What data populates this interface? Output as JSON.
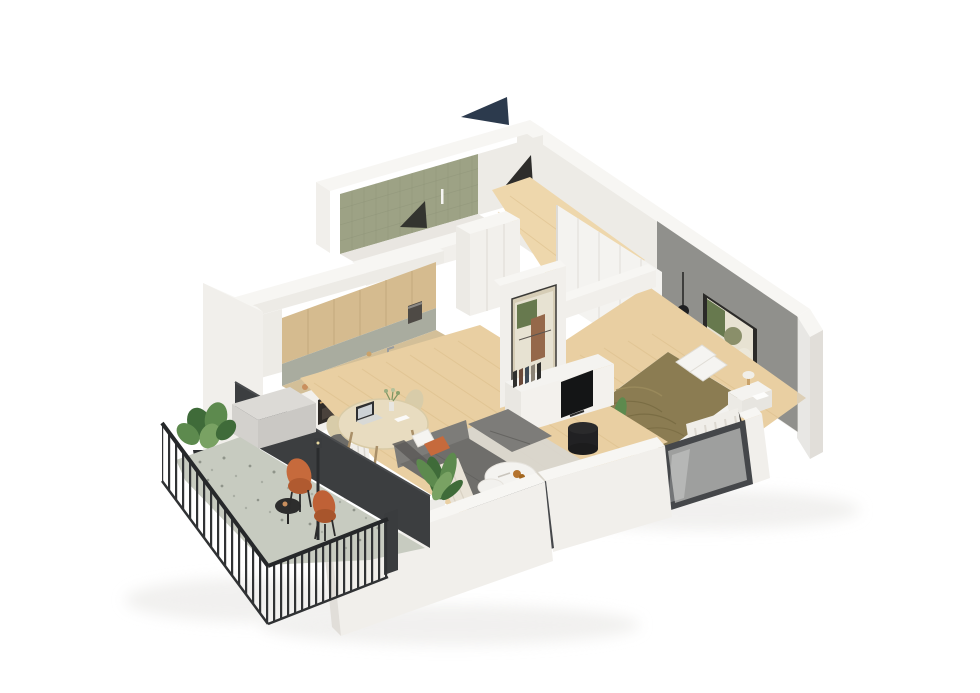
{
  "meta": {
    "description": "3D isometric cutaway rendering of a one-bedroom apartment floor plan on a white background, with north arrow, balcony, kitchen, living-dining room, bedroom and bathroom"
  },
  "compass": {
    "name": "north-arrow"
  },
  "palette": {
    "bg": "#ffffff",
    "navy": "#2c3a4d",
    "wallTop": "#f7f6f3",
    "wallLight": "#f1efeb",
    "wallMid": "#e1ded9",
    "wallShade": "#d2cfca",
    "wallInner": "#edebe6",
    "accentGray": "#90908c",
    "floorWood": "#e9cfa2",
    "floorWoodLight": "#eed7ac",
    "floorWoodLine": "#d8b983",
    "floorBath": "#e9e6e1",
    "tileOlive": "#9da285",
    "terrazzo": "#c7cbc0",
    "speckleA": "#8f948a",
    "speckleB": "#a9aea3",
    "darkWall": "#3c3e40",
    "railing": "#303234",
    "oak": "#d5bb8f",
    "backsplash": "#a9ac9f",
    "counter": "#d3bf98",
    "baseCab": "#f2f0ec",
    "applianceDark": "#2f3032",
    "bronze": "#c9a26a",
    "sofa": "#6f6e6b",
    "sofaLight": "#7d7c79",
    "sofaDark": "#5c5b58",
    "orange": "#c66a3c",
    "softWhite": "#f4f3f0",
    "throw": "#e9e3d7",
    "rug": "#d8d6d0",
    "duvet": "#8b7c52",
    "duvetShade": "#74673f",
    "pillow": "#f5f4f1",
    "plantDark": "#3f6b39",
    "plant": "#5d8a4e",
    "plantLight": "#79a263",
    "black": "#1f2022",
    "frameDark": "#3a3836",
    "artGreen": "#67794e",
    "artBrown": "#95684a",
    "artCream": "#e7e2d2",
    "glass": "#e8e8e4",
    "windowFrame": "#45474a",
    "woodLeg": "#a98f68",
    "chairBeige": "#d8cca9",
    "tableWood": "#e8dcc0",
    "shadow": "#ebeae8"
  },
  "rooms": [
    {
      "id": "bathroom",
      "label": "Bathroom",
      "features": [
        "olive tiled wall",
        "open dark doorway",
        "shower fixture"
      ]
    },
    {
      "id": "hall",
      "label": "Entry Hall",
      "features": [
        "open entry door",
        "tall white storage column"
      ]
    },
    {
      "id": "kitchen",
      "label": "Kitchen",
      "features": [
        "oak upper cabinets",
        "tiled backsplash",
        "beige countertop",
        "sink",
        "cooktop",
        "built-in oven",
        "coffee machine"
      ]
    },
    {
      "id": "living-dining",
      "label": "Living / Dining Room",
      "features": [
        "round dining table with laptop",
        "two wooden chairs",
        "gray corner sofa",
        "orange pillow",
        "white coffee table set with croissants",
        "indoor plant",
        "gray rug",
        "media console with TV",
        "framed abstract artwork",
        "window"
      ]
    },
    {
      "id": "bedroom",
      "label": "Bedroom",
      "features": [
        "double bed with olive duvet",
        "white wardrobe",
        "gray accent wall",
        "framed artwork",
        "black pendant lamp",
        "nightstand with lamp and laptop",
        "potted plant",
        "window with curtains"
      ]
    },
    {
      "id": "balcony",
      "label": "Balcony",
      "features": [
        "dark metal slat railing",
        "terrazzo floor",
        "two orange chairs",
        "black side table",
        "monstera plant",
        "storage box",
        "outdoor pole lamp"
      ]
    }
  ]
}
